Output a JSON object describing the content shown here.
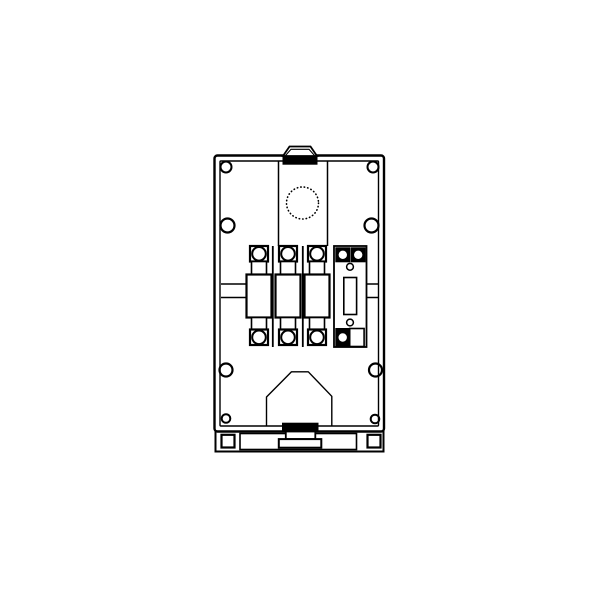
{
  "colors": {
    "ink": "#000000",
    "paper": "#ffffff"
  },
  "figure": {
    "kind": "technical-line-drawing",
    "subject": "Front view of a 3-pole fuse switch-disconnector enclosure with neutral switch module, cable-entry cover and DIN-rail base",
    "text_labels": [],
    "parts": {
      "fuse_poles": 3,
      "neutral_switch_modules": 1,
      "screw_holes_large": 6,
      "screw_holes_small": 2,
      "round_knockout_dotted": 1,
      "top_tab_knockout": 1,
      "din_rail_base": 1
    }
  }
}
